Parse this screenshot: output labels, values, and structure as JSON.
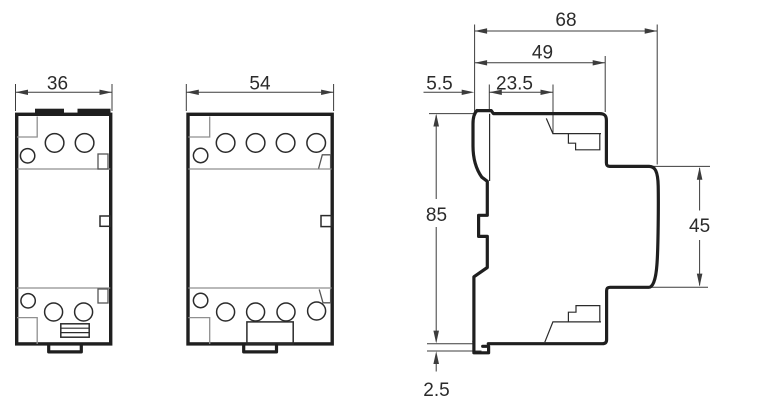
{
  "drawing": {
    "front_view_2pole": {
      "width_dim": "36"
    },
    "front_view_4pole": {
      "width_dim": "54"
    },
    "side_view": {
      "overall_depth_dim": "68",
      "upper_depth_dim": "49",
      "rail_offset_dim": "5.5",
      "top_depth_dim": "23.5",
      "height_dim": "85",
      "front_height_dim": "45",
      "bottom_clearance_dim": "2.5"
    },
    "colors": {
      "outline": "#1f1f1f",
      "dimension_lines": "#3c3c3c",
      "gray_detail": "#8f8f8f",
      "background": "#ffffff"
    }
  }
}
